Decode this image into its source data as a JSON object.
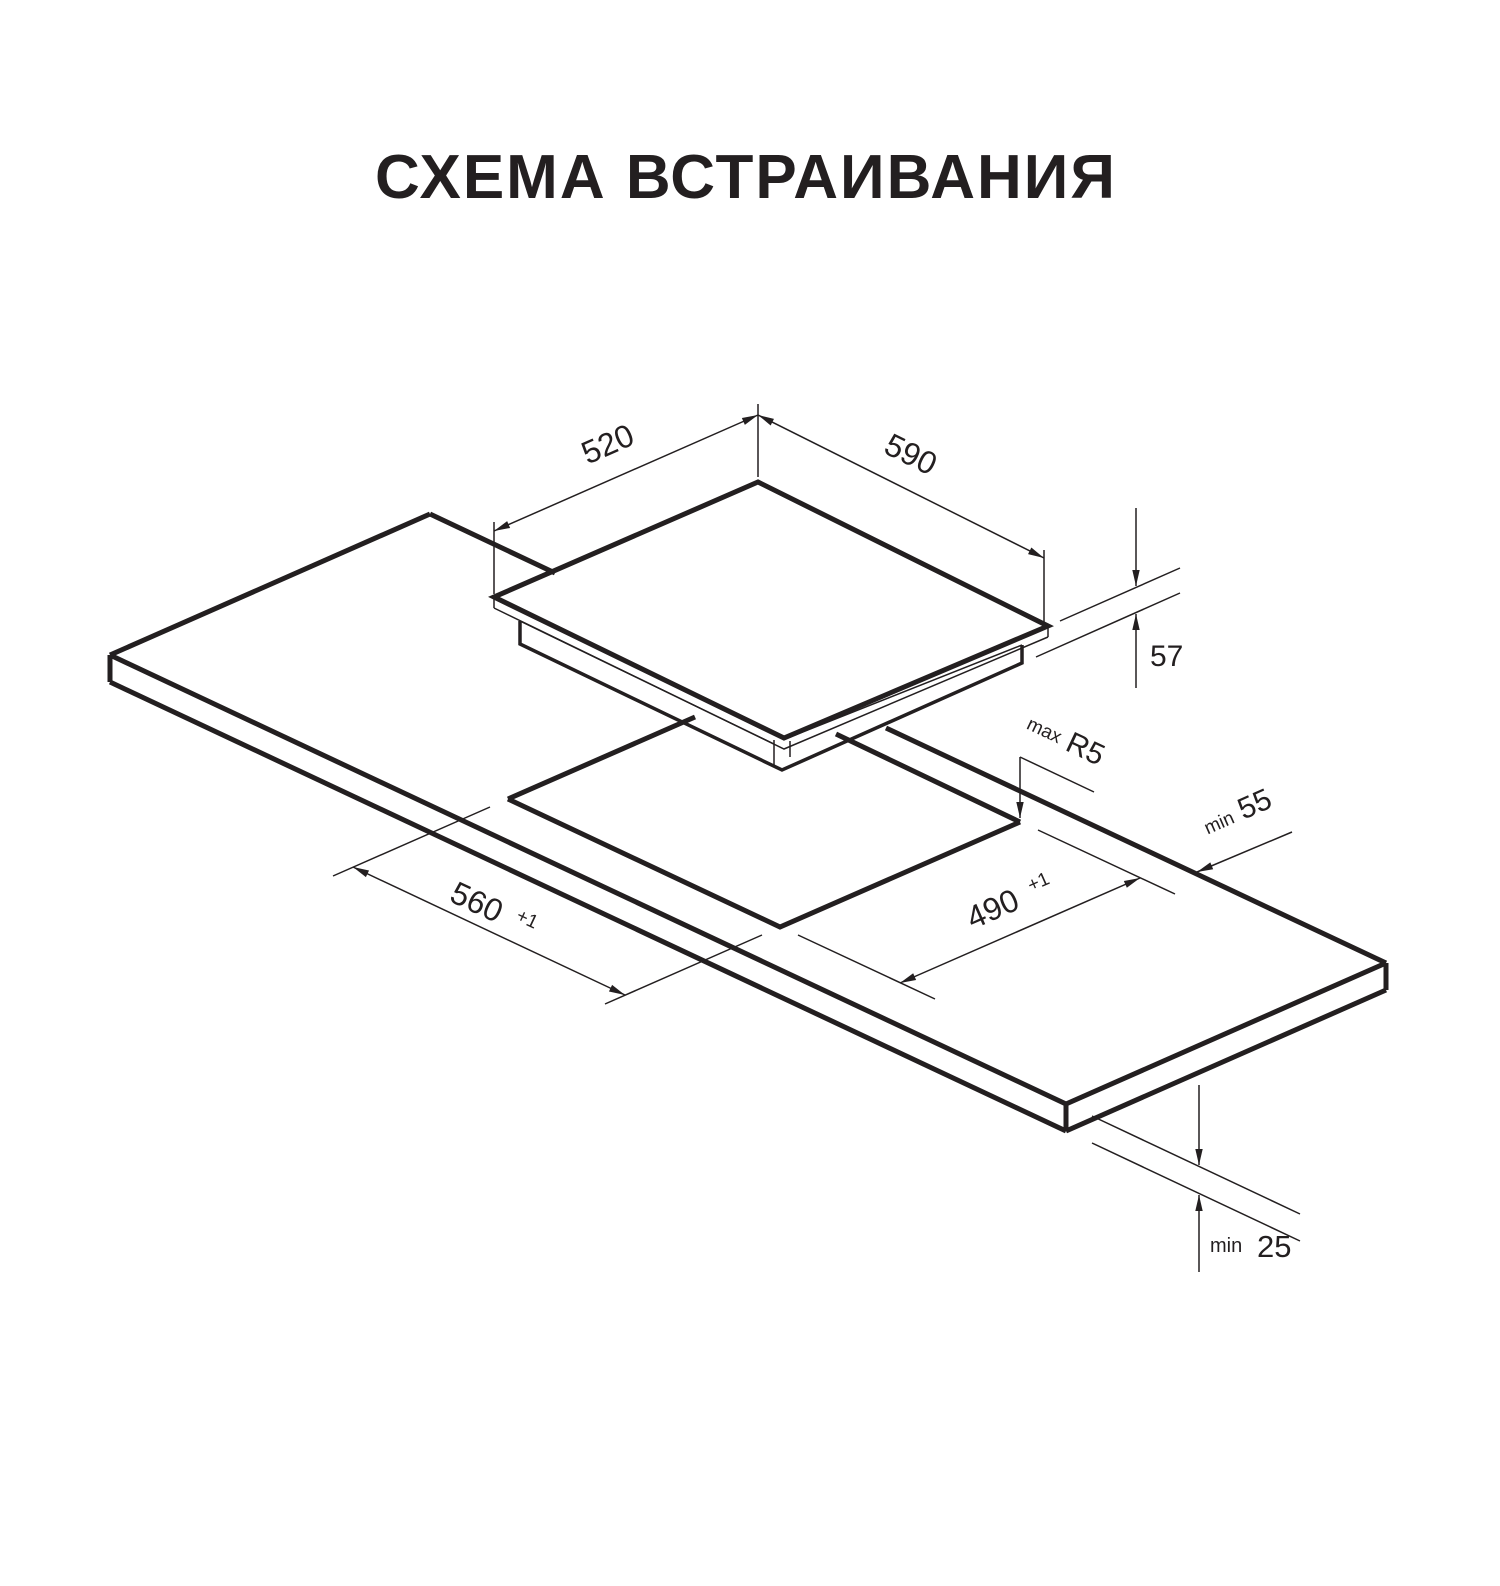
{
  "title": "СХЕМА ВСТРАИВАНИЯ",
  "colors": {
    "line": "#231f20",
    "background": "#ffffff"
  },
  "diagram_type": "built-in hob installation cutout drawing (isometric)",
  "labels": {
    "hob_depth": {
      "value": "520"
    },
    "hob_width": {
      "value": "590"
    },
    "hob_height": {
      "value": "57"
    },
    "cutout_length": {
      "value": "560",
      "tolerance": "+1"
    },
    "cutout_depth": {
      "value": "490",
      "tolerance": "+1"
    },
    "corner_radius": {
      "qualifier": "max",
      "value": "R5"
    },
    "rear_clearance": {
      "qualifier": "min",
      "value": "55"
    },
    "bottom_clearance": {
      "qualifier": "min",
      "value": "25"
    }
  }
}
